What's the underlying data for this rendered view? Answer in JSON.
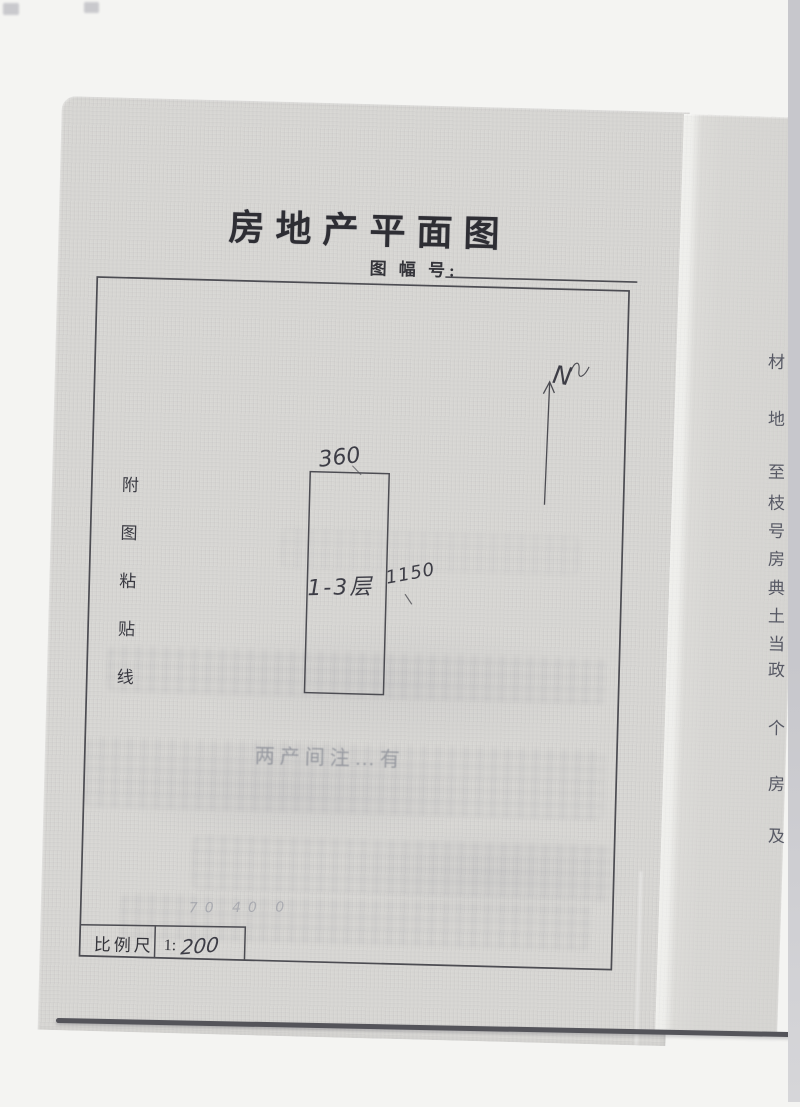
{
  "doc": {
    "title": "房地产平面图",
    "map_sheet_label": "图 幅 号:",
    "paste_line_label": "附图粘贴线",
    "plan": {
      "north_label": "N",
      "width_dimension": "360",
      "floor_label": "1-3层",
      "side_dimension": "1150",
      "faint_note": "两产间注…有",
      "pencil_note": "70 40 0"
    },
    "scale": {
      "label": "比例尺",
      "prefix": "1:",
      "value": "200"
    },
    "right_page_chars": [
      "材",
      "地",
      "至",
      "枝",
      "号",
      "房",
      "典",
      "土",
      "当",
      "政",
      "个",
      "房",
      "及"
    ],
    "colors": {
      "paper": "#d7d6d3",
      "ink": "#2e2e34",
      "pencil": "#3d3d46"
    }
  }
}
